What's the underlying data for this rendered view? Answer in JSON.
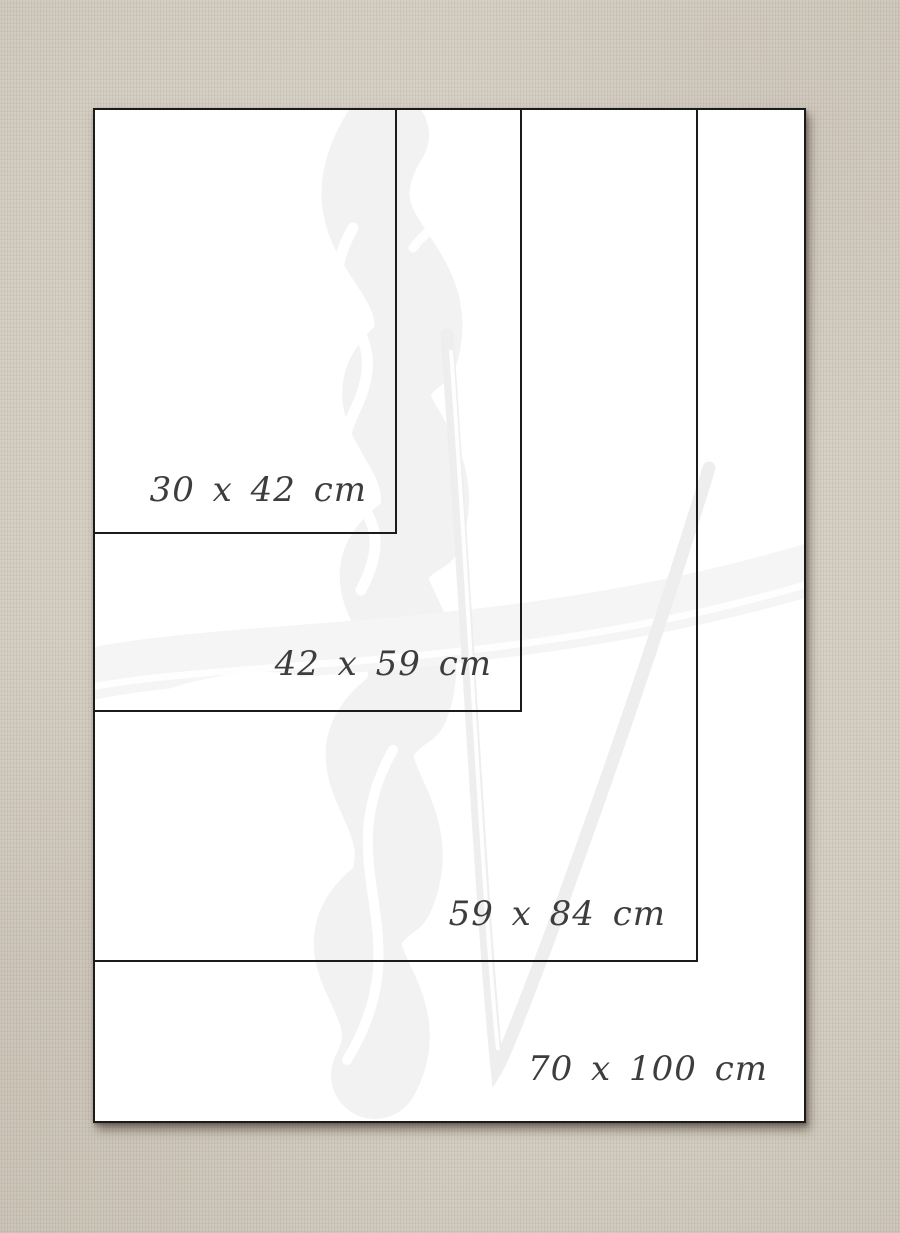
{
  "diagram": {
    "kind": "paper-size-comparison",
    "unit": "cm",
    "sizes": [
      {
        "label": "30 x 42 cm",
        "width_cm": 30,
        "height_cm": 42
      },
      {
        "label": "42 x 59 cm",
        "width_cm": 42,
        "height_cm": 59
      },
      {
        "label": "59 x 84 cm",
        "width_cm": 59,
        "height_cm": 84
      },
      {
        "label": "70 x 100 cm",
        "width_cm": 70,
        "height_cm": 100
      }
    ]
  },
  "colors": {
    "background_canvas": "#cfc7ba",
    "sheet": "#ffffff",
    "outline": "#1b1b1b",
    "label_text": "#3d3d3d",
    "watermark_gray": "#f2f2f2",
    "watermark_white": "#ffffff",
    "shadow": "rgba(70,60,48,0.55)"
  }
}
